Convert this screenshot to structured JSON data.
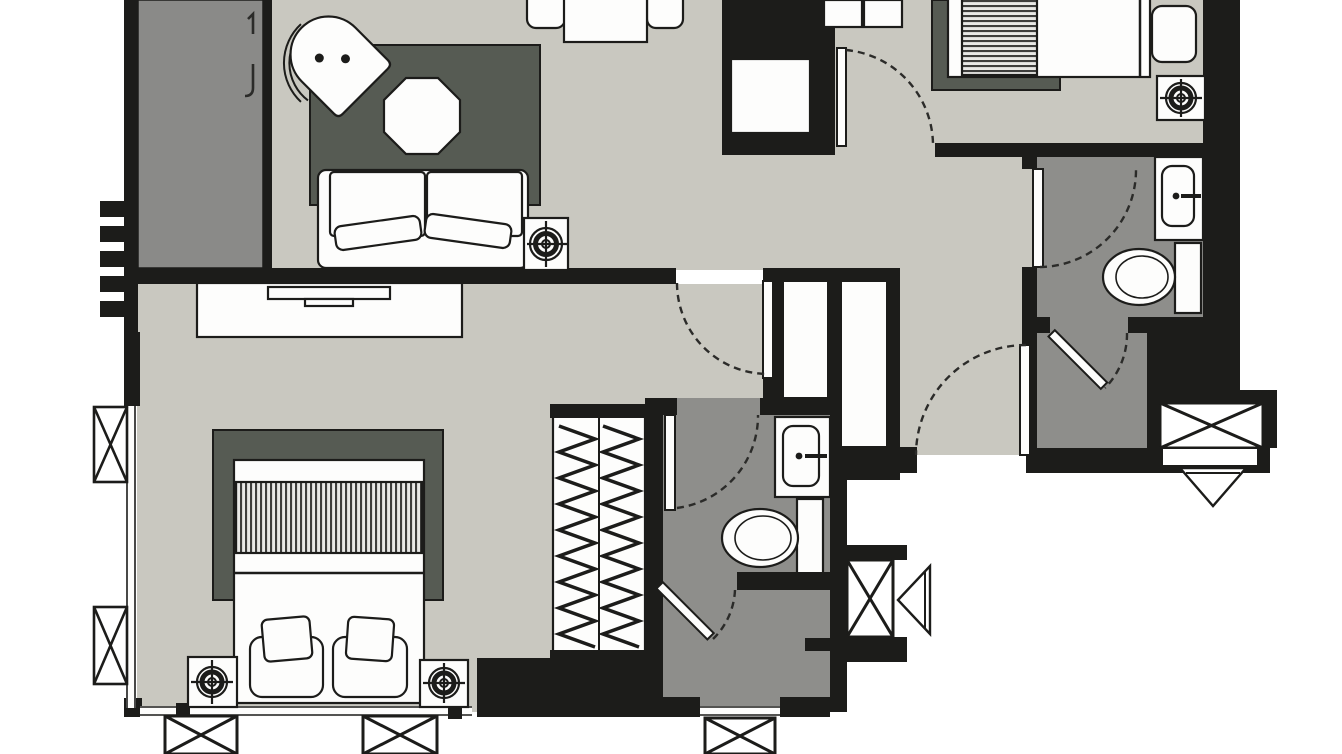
{
  "document": {
    "kind": "architectural-floor-plan",
    "description": "Black and white apartment floor plan with two bedrooms, living-dining area, two bathrooms, shower room, wardrobe and entry vestibule. No text labels are rendered on the drawing.",
    "canvas": {
      "width": 1342,
      "height": 754
    }
  },
  "palette": {
    "background": "#ffffff",
    "floor": "#c9c8c0",
    "wet_floor": "#8e8e8b",
    "rug": "#565b53",
    "closet_panel": "#8a8a88",
    "wall": "#1c1c1a",
    "furniture_fill": "#fdfdfc",
    "furniture_stroke": "#1c1c1a",
    "stripe": "#3e3e3c",
    "arc": "#2b2b29",
    "glyph": "#2b2b29"
  },
  "rooms": [
    {
      "name": "living-dining-area",
      "floor": "light"
    },
    {
      "name": "bedroom-main",
      "floor": "light"
    },
    {
      "name": "bedroom-second",
      "floor": "light"
    },
    {
      "name": "corridor",
      "floor": "light"
    },
    {
      "name": "bathroom-main",
      "floor": "dark"
    },
    {
      "name": "bathroom-second",
      "floor": "dark"
    },
    {
      "name": "shower-room",
      "floor": "dark"
    },
    {
      "name": "entry-vestibule",
      "floor": "dark"
    }
  ],
  "fixtures": [
    "sofa",
    "lounge-chair",
    "octagon-side-table",
    "dining-table",
    "dining-chairs",
    "tv-console",
    "flat-tv",
    "double-bed",
    "single-bed",
    "bed-pillows",
    "armchair",
    "wardrobe-hanging-rails",
    "closet-doors",
    "kitchen-unit",
    "sink-basin",
    "toilet",
    "lamp-target-unit",
    "window-x-box",
    "vent-funnel",
    "accordion-wall-element"
  ],
  "openings": {
    "hinged_doors": 7,
    "window_strips": 3,
    "x_box_units": 6
  }
}
